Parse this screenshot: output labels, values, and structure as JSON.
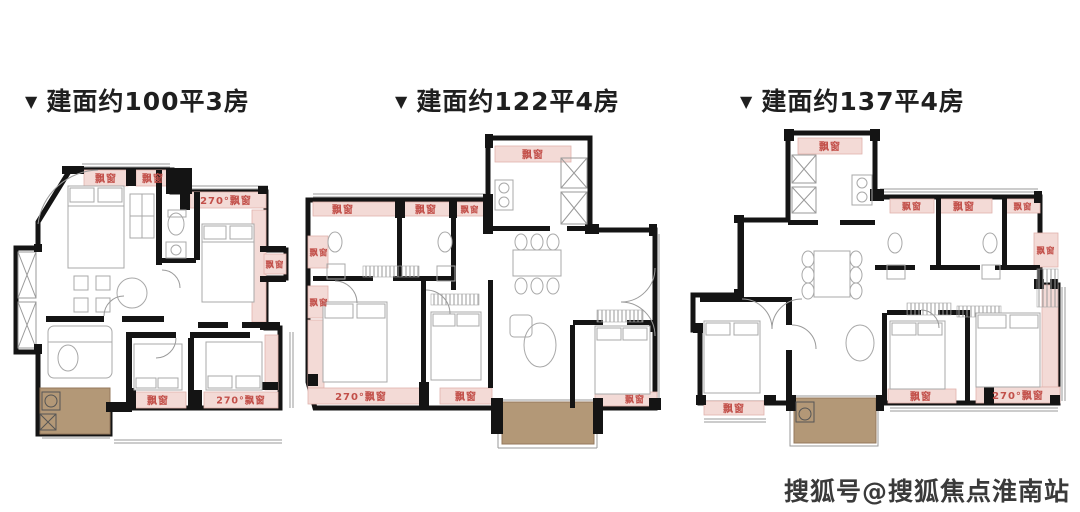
{
  "strings": {
    "bay": "飘窗",
    "bay270": "270°飘窗"
  },
  "plans": [
    {
      "marker": "▼",
      "title": "建面约100平3房"
    },
    {
      "marker": "▼",
      "title": "建面约122平4房"
    },
    {
      "marker": "▼",
      "title": "建面约137平4房"
    }
  ],
  "watermark": {
    "text": "搜狐号@搜狐焦点淮南站"
  },
  "colors": {
    "background": "#ffffff",
    "title_text": "#1f1f1f",
    "wall": "#141414",
    "thin_line": "#9a9a9a",
    "furn_line": "#a8a8a8",
    "bay_fill": "#f3dad6",
    "bay_border": "#e0b2ac",
    "bay_text": "#c24f49",
    "balcony_fill": "#b39877",
    "balcony_border": "#94795c",
    "watermark_text": "#3a3a3a"
  }
}
